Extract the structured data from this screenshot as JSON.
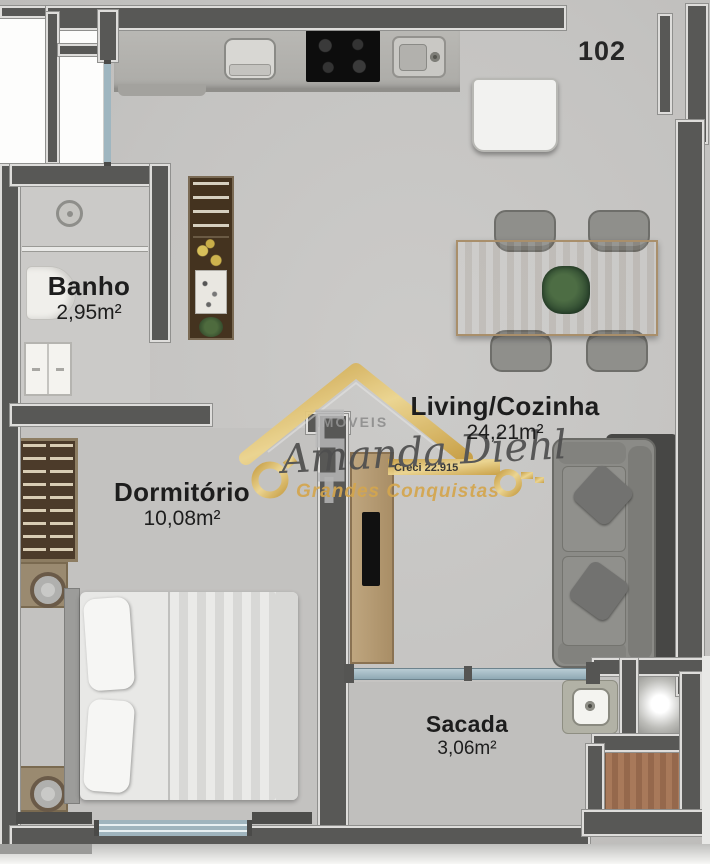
{
  "plan": {
    "unit_number": "102",
    "rooms": [
      {
        "id": "banho",
        "label": "Banho",
        "area": "2,95m²"
      },
      {
        "id": "dormitorio",
        "label": "Dormitório",
        "area": "10,08m²"
      },
      {
        "id": "living",
        "label": "Living/Cozinha",
        "area": "24,21m²"
      },
      {
        "id": "sacada",
        "label": "Sacada",
        "area": "3,06m²"
      }
    ]
  },
  "watermark": {
    "brand_top": "IMÓVEIS",
    "name": "Amanda Diehl",
    "creci": "Creci 22.915",
    "slogan": "Grandes Conquistas"
  },
  "colors": {
    "wall": "#585856",
    "floor": "#c7c6c4",
    "accent_gold": "#d8ab55",
    "label_text": "#1d1d1d"
  }
}
